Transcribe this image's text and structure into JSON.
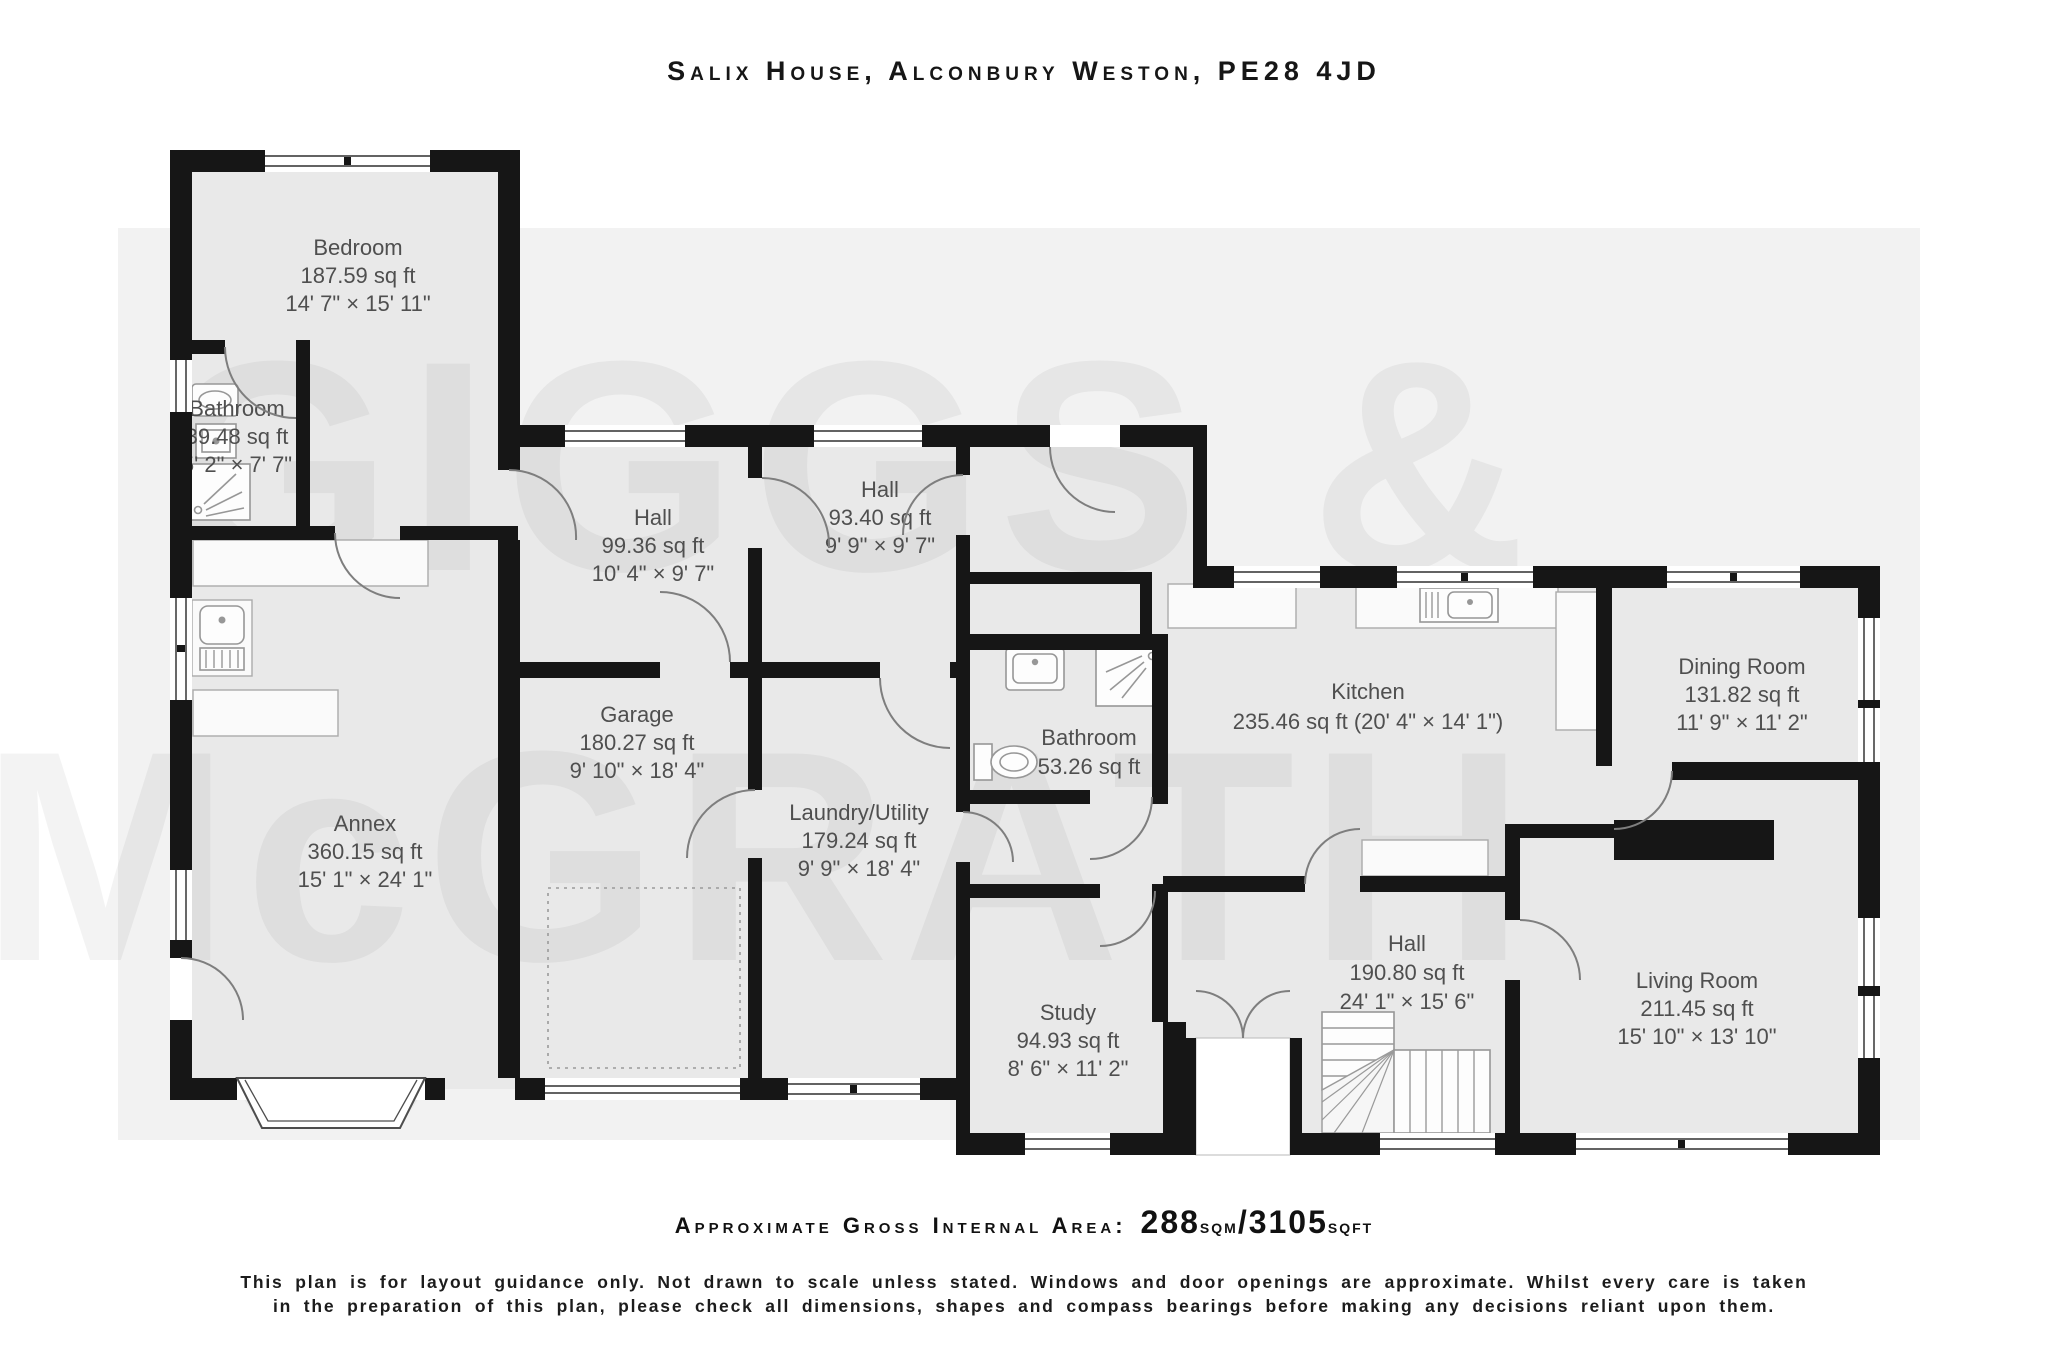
{
  "title": "Salix House, Alconbury Weston, PE28 4JD",
  "watermark": {
    "line1": "GIGGS &",
    "line2": "McGRATH"
  },
  "rooms": {
    "bedroom": {
      "name": "Bedroom",
      "area": "187.59 sq ft",
      "dims": "14' 7\" × 15' 11\""
    },
    "bathroom1": {
      "name": "Bathroom",
      "area": "39.48 sq ft",
      "dims": "5' 2\" × 7' 7\""
    },
    "hall1": {
      "name": "Hall",
      "area": "99.36 sq ft",
      "dims": "10' 4\" × 9' 7\""
    },
    "hall2": {
      "name": "Hall",
      "area": "93.40 sq ft",
      "dims": "9' 9\" × 9' 7\""
    },
    "annex": {
      "name": "Annex",
      "area": "360.15 sq ft",
      "dims": "15' 1\" × 24' 1\""
    },
    "garage": {
      "name": "Garage",
      "area": "180.27 sq ft",
      "dims": "9' 10\" × 18' 4\""
    },
    "laundry": {
      "name": "Laundry/Utility",
      "area": "179.24 sq ft",
      "dims": "9' 9\" × 18' 4\""
    },
    "bathroom2": {
      "name": "Bathroom",
      "area": "53.26 sq ft"
    },
    "kitchen": {
      "name": "Kitchen",
      "area": "235.46 sq ft (20' 4\" × 14' 1\")"
    },
    "dining": {
      "name": "Dining Room",
      "area": "131.82 sq ft",
      "dims": "11' 9\" × 11' 2\""
    },
    "study": {
      "name": "Study",
      "area": "94.93 sq ft",
      "dims": "8' 6\" × 11' 2\""
    },
    "hall3": {
      "name": "Hall",
      "area": "190.80 sq ft",
      "dims": "24' 1\" × 15' 6\""
    },
    "living": {
      "name": "Living Room",
      "area": "211.45 sq ft",
      "dims": "15' 10\" × 13' 10\""
    }
  },
  "footer": {
    "area_label": "Approximate Gross Internal Area:",
    "sqm_value": "288",
    "sqm_unit": "sqm",
    "separator": "/",
    "sqft_value": "3105",
    "sqft_unit": "sqft",
    "disclaimer_line1": "This plan is for layout guidance only. Not drawn to scale unless stated. Windows and door openings are approximate. Whilst every care is taken",
    "disclaimer_line2": "in the preparation of this plan, please check all dimensions, shapes and compass bearings before making any decisions reliant upon them."
  },
  "colors": {
    "wall": "#161616",
    "floor": "#e9e9e9",
    "label": "#4f4f4f",
    "backdrop": "#f2f2f2"
  }
}
